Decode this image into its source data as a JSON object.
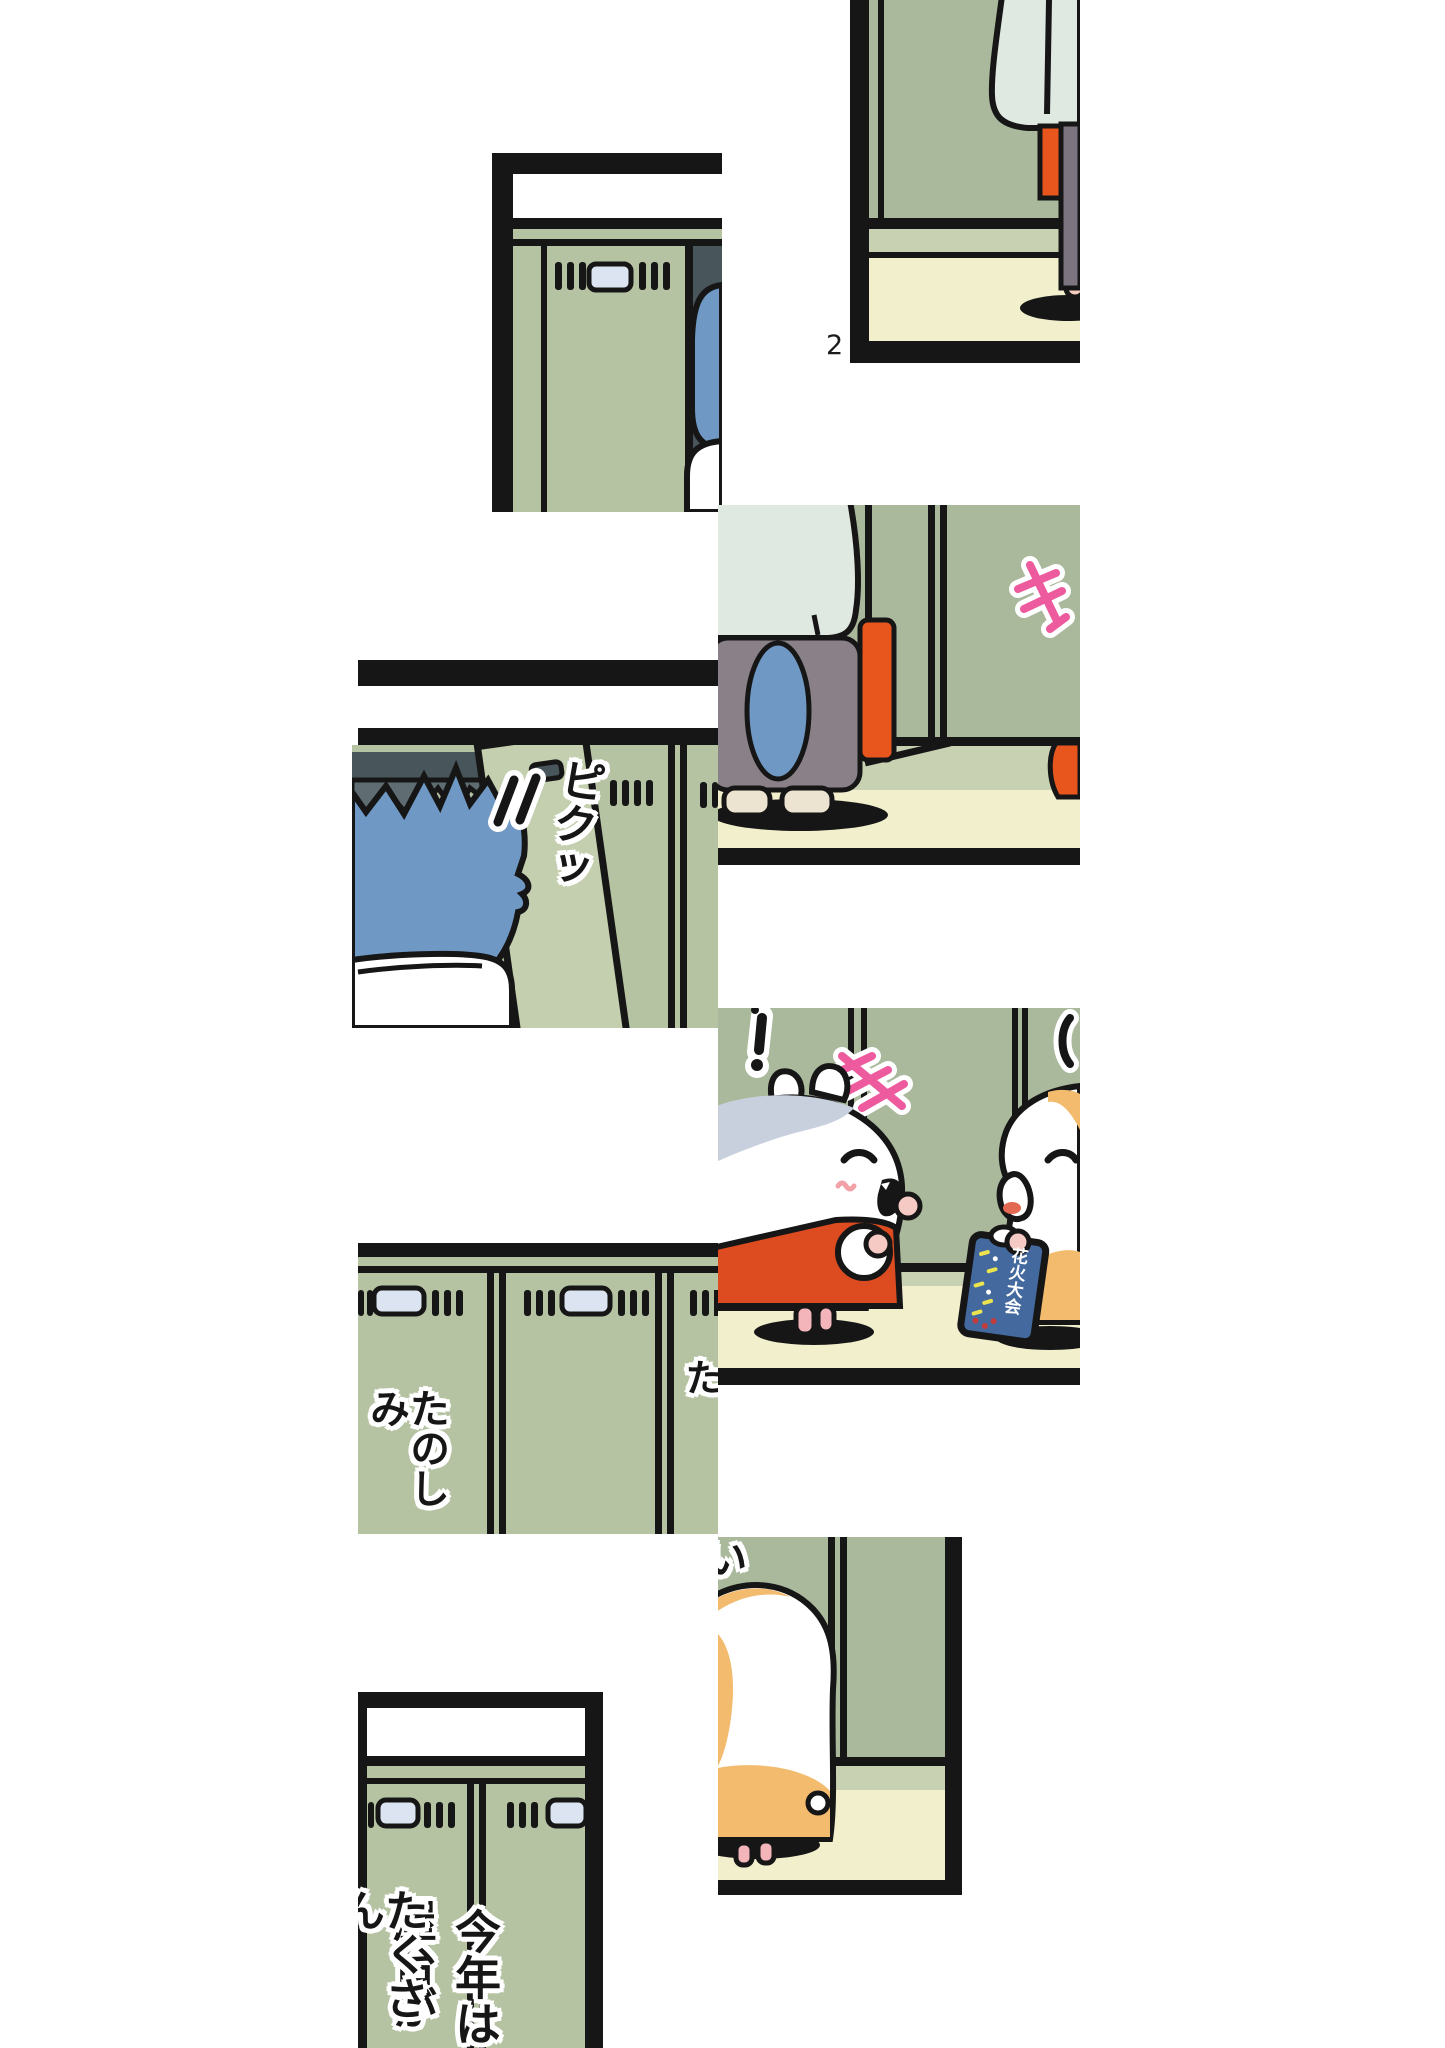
{
  "page": {
    "number": "2"
  },
  "sfx": {
    "pikutsu": "ピクッ"
  },
  "speech": {
    "locker_left": "たのしみ",
    "locker_right": "たのしみた",
    "locker_right_cont": "い",
    "bottom_col1": "今年は",
    "bottom_col2": "屋台が",
    "bottom_col3": "たくさん"
  },
  "packet": {
    "label": "花火大会"
  },
  "colors": {
    "ink": "#161616",
    "locker": "#b5c3a3",
    "wall": "#aab89b",
    "door": "#c3cfae",
    "base": "#c8d2b2",
    "floor": "#f2efcd",
    "plate": "#dce4f2",
    "dark1": "#48555b",
    "dark2": "#5f6d72",
    "hair": "#6f99c4",
    "mint": "#e0e9e1",
    "orange": "#e8561e",
    "apron": "#dd4b20",
    "pants": "#7c747e",
    "shorts": "#8a8088",
    "pink": "#ee5a9e",
    "hamorange": "#f2bb6d",
    "graypatch": "#c9d0dd",
    "skin": "#f5c9c4",
    "feet": "#f3b5ba",
    "packet": "#44699f",
    "tongue": "#e36952",
    "shoe": "#ece3d0",
    "heel": "#f4cdbe",
    "speck_yellow": "#ece44e",
    "speck_red": "#c43c3c"
  }
}
